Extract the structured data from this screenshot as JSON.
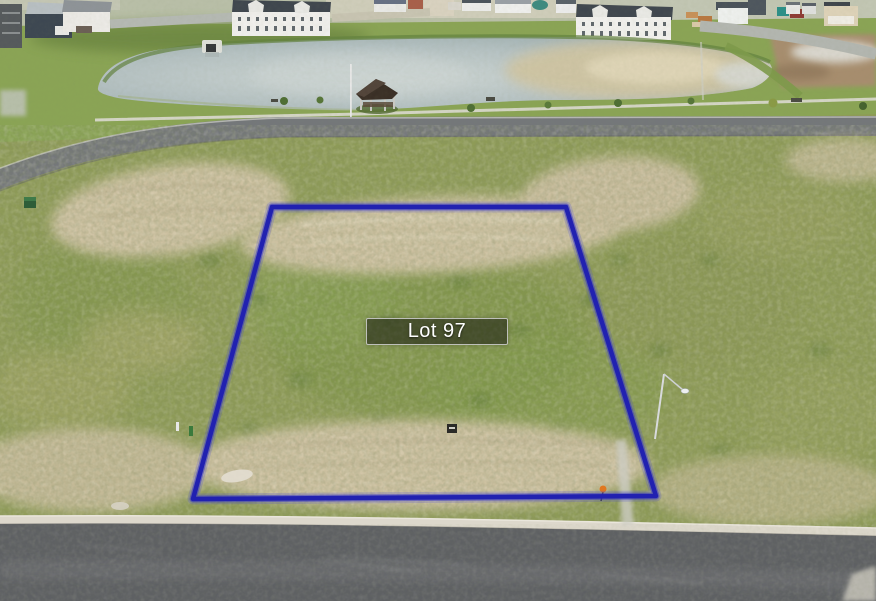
{
  "photo": {
    "type": "aerial-drone-photo",
    "subject": "Vacant residential lot outlined for sale, with pond, gazebo and houses to the north",
    "lot": {
      "label": "Lot 97"
    },
    "boundary": {
      "color": "#2222b2",
      "points": "272,207 566,207 656,496 193,499"
    },
    "palette": {
      "boundary_blue": "#2222b2",
      "label_background": "rgba(30,34,20,0.6)",
      "label_border": "#d0d0d0",
      "label_text": "#ffffff",
      "grass_field": "#8e9b57",
      "sand_dirt": "#cdc1a1",
      "pond_water": "#b6c2c3",
      "asphalt_road": "#5e6063",
      "curb_concrete": "#ddd8cc"
    }
  }
}
